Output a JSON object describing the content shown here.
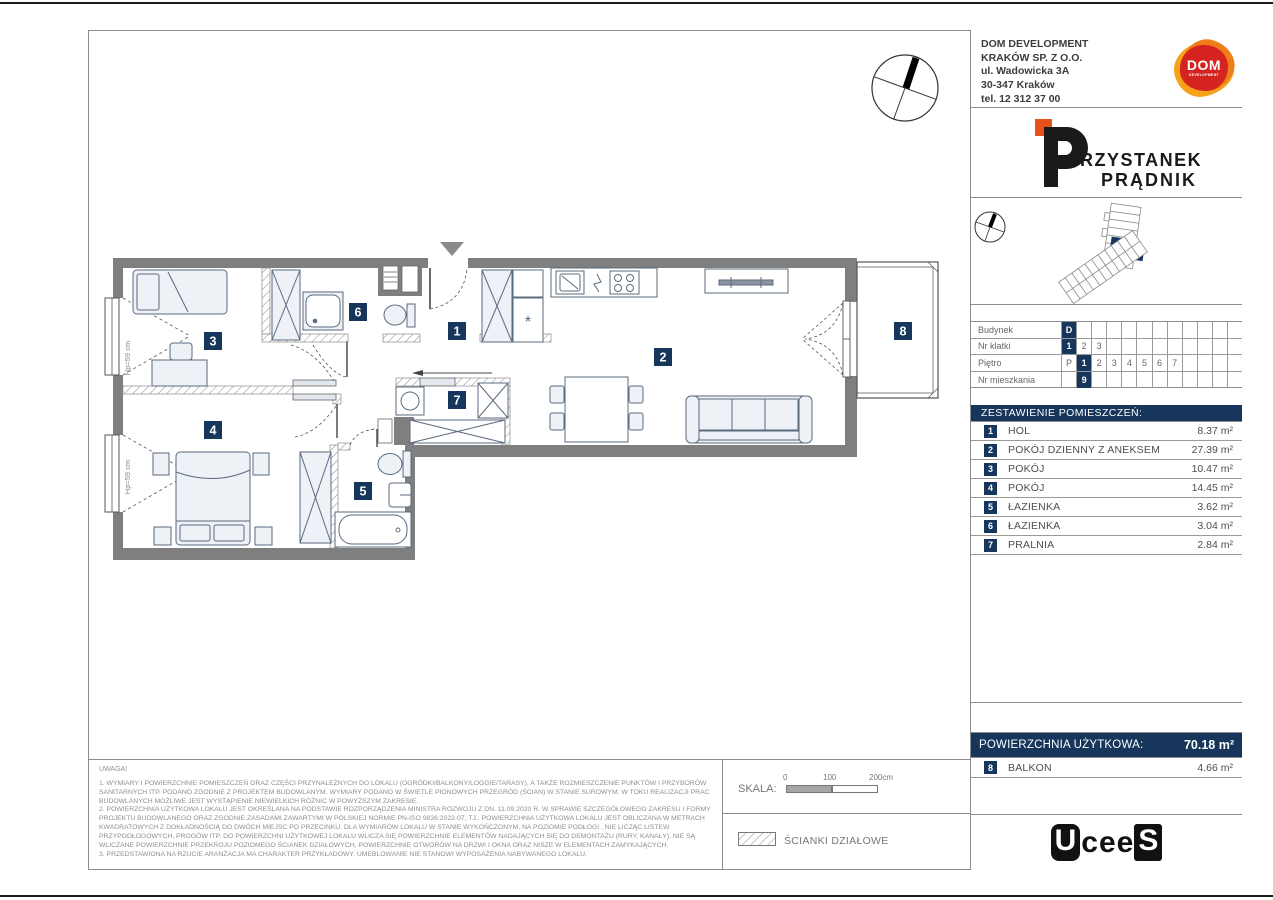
{
  "colors": {
    "navy": "#16365C",
    "wall_gray": "#7f7f7f",
    "logo_orange": "#F6A21A",
    "logo_red": "#D5231F",
    "accent_orange": "#E8501E"
  },
  "title_block": {
    "company": {
      "line1": "DOM DEVELOPMENT",
      "line2": "KRAKÓW SP. Z O.O.",
      "line3": "ul. Wadowicka 3A",
      "line4": "30-347 Kraków",
      "line5": "tel. 12 312 37 00",
      "logo_word": "DOM",
      "logo_sub": "DEVELOPMENT"
    },
    "project": {
      "name_line1_rest": "RZYSTANEK",
      "name_line2": "PRĄDNIK"
    },
    "location_table": {
      "rows": [
        {
          "label": "Budynek",
          "cells": [
            "D",
            "",
            "",
            "",
            "",
            "",
            "",
            "",
            "",
            "",
            "",
            ""
          ]
        },
        {
          "label": "Nr klatki",
          "cells": [
            "1",
            "2",
            "3",
            "",
            "",
            "",
            "",
            "",
            "",
            "",
            "",
            ""
          ]
        },
        {
          "label": "Piętro",
          "cells": [
            "P",
            "1",
            "2",
            "3",
            "4",
            "5",
            "6",
            "7",
            "",
            "",
            "",
            ""
          ]
        },
        {
          "label": "Nr mieszkania",
          "cells": [
            "",
            "9",
            "",
            "",
            "",
            "",
            "",
            "",
            "",
            "",
            "",
            ""
          ]
        }
      ]
    },
    "rooms_table": {
      "header": "ZESTAWIENIE POMIESZCZEŃ:",
      "rows": [
        {
          "no": "1",
          "name": "HOL",
          "area": "8.37 m²"
        },
        {
          "no": "2",
          "name": "POKÓJ DZIENNY Z ANEKSEM",
          "area": "27.39 m²"
        },
        {
          "no": "3",
          "name": "POKÓJ",
          "area": "10.47 m²"
        },
        {
          "no": "4",
          "name": "POKÓJ",
          "area": "14.45 m²"
        },
        {
          "no": "5",
          "name": "ŁAZIENKA",
          "area": "3.62 m²"
        },
        {
          "no": "6",
          "name": "ŁAZIENKA",
          "area": "3.04 m²"
        },
        {
          "no": "7",
          "name": "PRALNIA",
          "area": "2.84 m²"
        }
      ]
    },
    "usable_area": {
      "label": "POWIERZCHNIA UŻYTKOWA:",
      "value": "70.18 m²"
    },
    "balcony_row": {
      "no": "8",
      "name": "BALKON",
      "area": "4.66 m²"
    },
    "footer_logo": {
      "l1": "U",
      "l2": "c",
      "l3": "e",
      "l4": "e",
      "l5": "S"
    }
  },
  "plan": {
    "badges": [
      "1",
      "2",
      "3",
      "4",
      "5",
      "6",
      "7",
      "8"
    ],
    "window_labels": [
      "Hp=59 cm",
      "Hp=59 cm"
    ],
    "fridge_symbol": "*"
  },
  "notes": {
    "title": "UWAGA!",
    "item1": "1. WYMIARY I POWIERZCHNIE POMIESZCZEŃ ORAZ CZĘŚCI PRZYNALEŻNYCH DO LOKALU (OGRÓDKI/BALKONY/LOGGIE/TARASY), A TAKŻE ROZMIESZCZENIE PUNKTÓW I PRZYBORÓW SANITARNYCH ITP. PODANO ZGODNIE Z PROJEKTEM BUDOWLANYM. WYMIARY PODANO W ŚWIETLE PIONOWYCH PRZEGRÓD (ŚCIAN) W STANIE SUROWYM. W TOKU REALIZACJI PRAC BUDOWLANYCH MOŻLIWE JEST WYSTĄPIENIE NIEWIELKICH RÓŻNIC W POWYŻSZYM ZAKRESIE.",
    "item2": "2. POWIERZCHNIA UŻYTKOWA LOKALU JEST OKREŚLANA NA PODSTAWIE ROZPORZĄDZENIA MINISTRA ROZWOJU Z DN. 11.09.2020 R. W SPRAWIE SZCZEGÓŁOWEGO ZAKRESU I FORMY PROJEKTU BUDOWLANEGO ORAZ ZGODNIE ZASADAMI ZAWARTYMI W POLSKIEJ NORMIE PN-ISO 9836:2022-07, TJ.: POWIERZCHNIA UŻYTKOWA LOKALU JEST OBLICZANA W METRACH KWADRATOWYCH Z DOKŁADNOŚCIĄ DO DWÓCH MIEJSC PO PRZECINKU, DLA WYMIARÓW LOKALU W STANIE WYKOŃCZONYM, NA POZIOMIE PODŁOGI , NIE LICZĄC LISTEW PRZYPODŁOGOWYCH, PROGÓW ITP. DO POWIERZCHNI UŻYTKOWEJ LOKALU WLICZA SIĘ POWIERZCHNIE ELEMENTÓW NADAJĄCYCH SIĘ DO DEMONTAŻU (RURY, KANAŁY), NIE SĄ WLICZANE POWIERZCHNIE PRZEKROJU POZIOMEGO ŚCIANEK DZIAŁOWYCH, POWIERZCHNIE OTWORÓW NA DRZWI I OKNA ORAZ NISZE W ELEMENTACH ZAMYKAJĄCYCH.",
    "item3": "3. PRZEDSTAWIONA NA RZUCIE ARANŻACJA MA CHARAKTER PRZYKŁADOWY, UMEBLOWANIE NIE STANOWI WYPOSAŻENIA NABYWANEGO LOKALU."
  },
  "scale": {
    "label": "SKALA:",
    "tick0": "0",
    "tick100": "100",
    "tick200": "200cm"
  },
  "legend": {
    "partition_label": "ŚCIANKI DZIAŁOWE"
  }
}
